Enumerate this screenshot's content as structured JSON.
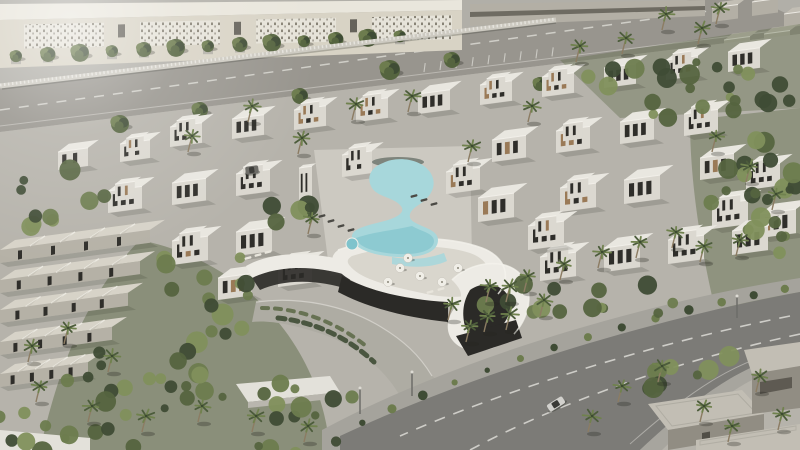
{
  "palette": {
    "ground": "#a8a59c",
    "paving": "#b6b3ab",
    "plaza": "#b1afa8",
    "roadTop": "#98958e",
    "roadMain": "#7c7b77",
    "roadLine": "#dddcd6",
    "sidewalk": "#a5a39c",
    "facadeCream": "#d8d3c5",
    "facadeRoof": "#e9e6dc",
    "facadePanel": "#e6e3d9",
    "facadeDot": "#6f6a5d",
    "fence": "#cdcac1",
    "fenceSlat": "#f0eee8",
    "bgBuilding": "#b3afa5",
    "bgBuildingSide": "#918d83",
    "bgRoof": "#c2beb4",
    "bgWindow": "#514e46",
    "villaRoof": "#e9e7e0",
    "villaFace": "#dbd8d0",
    "villaSide": "#b5b2aa",
    "roofEdge": "#f4f2ec",
    "windowDark": "#2f2e2a",
    "wood": "#9a7a57",
    "thRoof": "#d7d3c8",
    "thFace": "#b5b1a6",
    "thRidge": "#eceae2",
    "poolDeck": "#ccc9c1",
    "pool": "#a7d7db",
    "poolDeep": "#7fc3cc",
    "poolEdge": "#3e4a44",
    "deck": "#d9d6cd",
    "clubWhite": "#edebe5",
    "glass": "#2b2a27",
    "pavers": "#aeaca3",
    "planterWall": "#e3e1da",
    "planterSide": "#b9b6ae",
    "foliage1": "#3f4c35",
    "foliage2": "#55643f",
    "foliage3": "#6d7c4e",
    "foliage4": "#81905c",
    "palmGreen": "#4c5c3b",
    "palmLight": "#70824e",
    "trunk": "#8c7c63",
    "shadow": "#23261e",
    "lounger": "#4b4a45",
    "loungerLight": "#e8e5dc",
    "umbrella": "#f0eee7",
    "car": "#d2d1cd",
    "carGlass": "#3a3a36",
    "carDark": "#6b6a65",
    "lamp": "#6d6c68"
  },
  "scene": {
    "villas": [
      [
        170,
        127,
        32,
        26,
        20,
        1
      ],
      [
        232,
        119,
        32,
        26,
        20,
        0
      ],
      [
        294,
        110,
        32,
        26,
        20,
        1
      ],
      [
        356,
        102,
        32,
        26,
        20,
        1
      ],
      [
        418,
        94,
        32,
        26,
        20,
        0
      ],
      [
        480,
        85,
        32,
        26,
        20,
        1
      ],
      [
        542,
        77,
        32,
        26,
        20,
        1
      ],
      [
        604,
        68,
        32,
        26,
        20,
        0
      ],
      [
        666,
        60,
        32,
        26,
        20,
        1
      ],
      [
        728,
        52,
        32,
        26,
        20,
        0
      ],
      [
        108,
        191,
        34,
        28,
        22,
        1
      ],
      [
        172,
        183,
        34,
        28,
        22,
        0
      ],
      [
        236,
        174,
        34,
        28,
        22,
        1
      ],
      [
        342,
        155,
        30,
        26,
        22,
        1
      ],
      [
        446,
        172,
        34,
        28,
        22,
        1
      ],
      [
        492,
        140,
        34,
        28,
        22,
        0
      ],
      [
        556,
        131,
        34,
        28,
        22,
        1
      ],
      [
        620,
        122,
        34,
        28,
        22,
        0
      ],
      [
        684,
        114,
        34,
        28,
        22,
        1
      ],
      [
        700,
        158,
        34,
        28,
        22,
        0
      ],
      [
        746,
        168,
        34,
        28,
        22,
        1
      ],
      [
        712,
        205,
        36,
        30,
        24,
        1
      ],
      [
        760,
        214,
        36,
        30,
        24,
        0
      ],
      [
        172,
        241,
        36,
        30,
        24,
        1
      ],
      [
        236,
        232,
        36,
        30,
        24,
        0
      ],
      [
        560,
        188,
        36,
        30,
        24,
        1
      ],
      [
        624,
        180,
        36,
        30,
        24,
        0
      ],
      [
        540,
        257,
        36,
        30,
        24,
        1
      ],
      [
        604,
        248,
        36,
        30,
        24,
        0
      ],
      [
        668,
        240,
        36,
        30,
        24,
        1
      ],
      [
        732,
        231,
        36,
        30,
        24,
        0
      ],
      [
        58,
        152,
        30,
        24,
        18,
        0
      ],
      [
        120,
        144,
        30,
        24,
        18,
        1
      ],
      [
        218,
        278,
        34,
        28,
        22,
        0
      ],
      [
        278,
        265,
        34,
        28,
        22,
        1
      ],
      [
        478,
        198,
        36,
        30,
        24,
        0
      ],
      [
        528,
        226,
        36,
        30,
        24,
        1
      ]
    ],
    "tower": [
      299,
      168,
      13,
      9,
      34
    ],
    "bg_blocks": [
      [
        712,
        8
      ],
      [
        752,
        2
      ],
      [
        784,
        14
      ],
      [
        724,
        40
      ],
      [
        764,
        34
      ],
      [
        792,
        44
      ]
    ],
    "townhouses": [
      [
        0,
        250,
        150
      ],
      [
        0,
        280,
        140
      ],
      [
        0,
        310,
        128
      ],
      [
        0,
        342,
        112
      ],
      [
        0,
        374,
        88
      ]
    ],
    "street_trees": {
      "x0": 16,
      "step": 32,
      "count": 13
    },
    "parking": {
      "x0": 424,
      "step": 16,
      "count": 9
    },
    "facade_panels": [
      [
        24,
        104
      ],
      [
        140,
        220
      ],
      [
        256,
        336
      ],
      [
        372,
        452
      ]
    ],
    "facade_windows": [
      118,
      234,
      350
    ],
    "trees": [
      [
        390,
        70,
        10
      ],
      [
        300,
        96,
        8
      ],
      [
        452,
        60,
        8
      ],
      [
        540,
        84,
        7
      ],
      [
        200,
        110,
        8
      ],
      [
        120,
        124,
        9
      ]
    ],
    "foliage_clusters": [
      [
        688,
        88,
        110,
        34,
        24
      ],
      [
        756,
        220,
        46,
        90,
        22
      ],
      [
        196,
        296,
        64,
        56,
        16
      ],
      [
        140,
        398,
        95,
        52,
        20
      ],
      [
        300,
        414,
        70,
        40,
        14
      ],
      [
        48,
        428,
        70,
        26,
        10
      ],
      [
        52,
        196,
        60,
        34,
        10
      ],
      [
        592,
        302,
        120,
        26,
        14
      ],
      [
        700,
        374,
        70,
        26,
        9
      ],
      [
        292,
        212,
        24,
        16,
        5
      ]
    ],
    "palms": [
      [
        622,
        54
      ],
      [
        662,
        30
      ],
      [
        698,
        44
      ],
      [
        576,
        62
      ],
      [
        716,
        24
      ],
      [
        352,
        120
      ],
      [
        298,
        154
      ],
      [
        408,
        112
      ],
      [
        468,
        162
      ],
      [
        248,
        122
      ],
      [
        188,
        152
      ],
      [
        528,
        122
      ],
      [
        308,
        234
      ],
      [
        712,
        152
      ],
      [
        746,
        182
      ],
      [
        700,
        262
      ],
      [
        736,
        256
      ],
      [
        772,
        210
      ],
      [
        448,
        320
      ],
      [
        486,
        302
      ],
      [
        524,
        292
      ],
      [
        560,
        280
      ],
      [
        598,
        268
      ],
      [
        636,
        258
      ],
      [
        672,
        248
      ],
      [
        466,
        342
      ],
      [
        506,
        330
      ],
      [
        540,
        316
      ],
      [
        618,
        402
      ],
      [
        658,
        382
      ],
      [
        700,
        422
      ],
      [
        588,
        432
      ],
      [
        756,
        392
      ],
      [
        728,
        442
      ],
      [
        778,
        430
      ],
      [
        36,
        402
      ],
      [
        88,
        422
      ],
      [
        142,
        432
      ],
      [
        198,
        422
      ],
      [
        252,
        432
      ],
      [
        304,
        442
      ],
      [
        28,
        362
      ],
      [
        108,
        372
      ],
      [
        64,
        344
      ],
      [
        484,
        332
      ],
      [
        506,
        302
      ]
    ],
    "median_shrubs": {
      "p0": [
        800,
        286
      ],
      "p1": [
        660,
        312
      ],
      "p2": [
        480,
        362
      ],
      "p3": [
        348,
        430
      ],
      "count": 14
    },
    "umbrellas": [
      [
        400,
        268
      ],
      [
        420,
        276
      ],
      [
        442,
        282
      ],
      [
        388,
        282
      ],
      [
        458,
        268
      ],
      [
        408,
        258
      ]
    ],
    "loungers_dark": [
      [
        322,
        216
      ],
      [
        331,
        221
      ],
      [
        341,
        226
      ],
      [
        351,
        230
      ],
      [
        414,
        196
      ],
      [
        424,
        200
      ],
      [
        434,
        204
      ]
    ],
    "loungers_light": [
      [
        248,
        258
      ],
      [
        258,
        255
      ],
      [
        268,
        252
      ],
      [
        430,
        292
      ],
      [
        441,
        289
      ]
    ],
    "cars": [
      {
        "x": 556,
        "y": 404,
        "rot": -32,
        "len": 18,
        "dark": false
      },
      {
        "x": 252,
        "y": 170,
        "rot": -8,
        "len": 13,
        "dark": true
      }
    ],
    "lamps": [
      [
        360,
        388,
        26
      ],
      [
        412,
        372,
        24
      ],
      [
        737,
        296,
        22
      ]
    ]
  }
}
